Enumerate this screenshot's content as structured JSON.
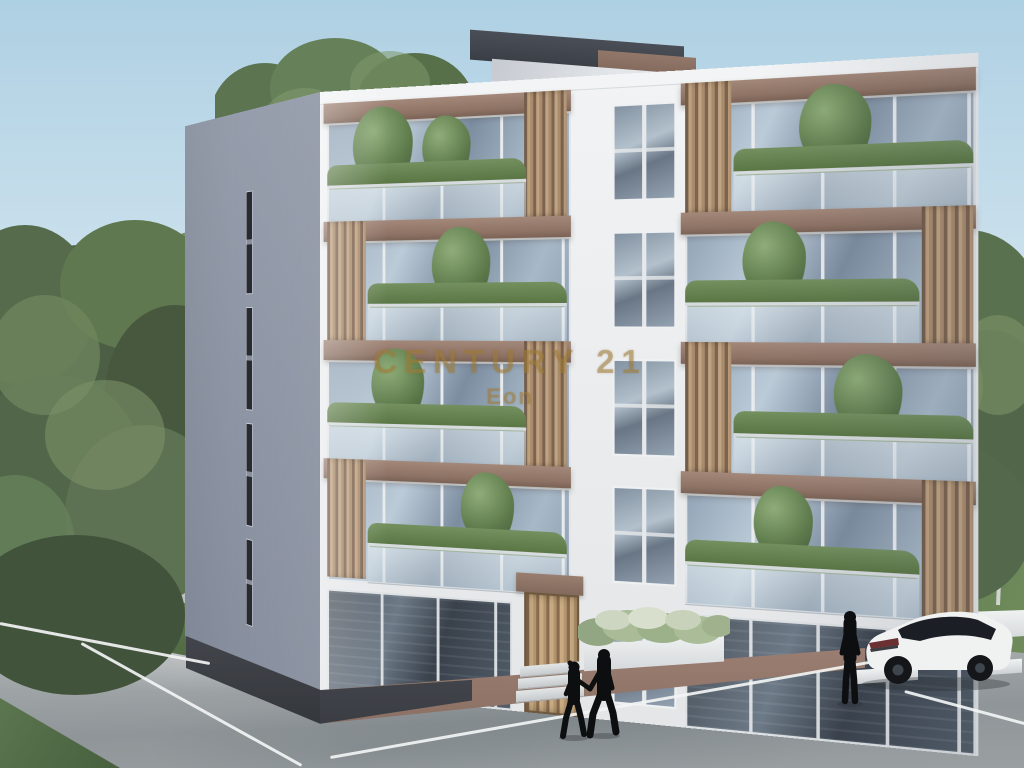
{
  "watermark": {
    "brand": "CENTURY 21",
    "subtitle": "Eon"
  },
  "scene": {
    "type": "architectural-exterior-rendering",
    "subject": "Modern five-storey white apartment building with brown balcony frames, wooden slat screens, balcony plants, grey side wall with slit windows and a rooftop stair tower",
    "counts": {
      "storeys": 5,
      "people": 3,
      "cars": 1
    },
    "elements": [
      "sky",
      "background trees",
      "apartment building",
      "rooftop tower",
      "balconies with plants",
      "glass railings",
      "wooden entrance door",
      "stone planter with shrubs",
      "concrete driveway with white parking lines",
      "grass and lawn",
      "white SUV with black roof",
      "couple walking holding hands",
      "standing person silhouette"
    ],
    "palette": {
      "sky_top": "#aed0e3",
      "sky_horizon": "#f3f6f5",
      "facade_white": "#eceef0",
      "side_wall_grey": "#8f97a6",
      "accent_brown": "#8e7365",
      "wood_slats": "#c0a381",
      "glass_blue": "#9fb2c4",
      "glass_dark": "#4a525c",
      "foliage_dark": "#4e6342",
      "foliage_light": "#7f9c6b",
      "pavement_grey": "#a6abae",
      "grass_green": "#5d7a4c",
      "plinth_dark": "#3a3d42",
      "plinth_brown": "#9b7f72",
      "car_body": "#f0f1f1",
      "car_roof": "#15171b",
      "watermark_gold": "#a3803a",
      "silhouette_black": "#0d0e10"
    }
  }
}
